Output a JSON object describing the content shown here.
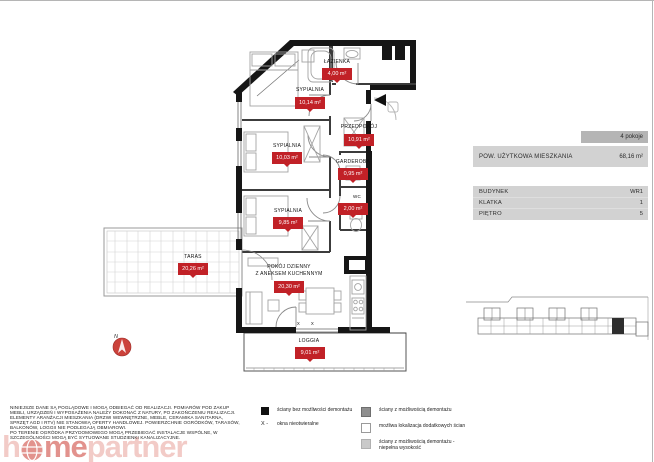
{
  "colors": {
    "badge_red": "#c12127",
    "wall_black": "#161616",
    "panel_gray": "#d2d2d2",
    "panel_band_gray": "#b5b5b5",
    "logo_salmon": "#eba9a3",
    "logo_red": "#cf4a42"
  },
  "floorplan": {
    "north_label": "N",
    "window_marker": "x",
    "rooms": [
      {
        "name": "ŁAZIENKA",
        "area": "4,00 m²"
      },
      {
        "name": "SYPIALNIA",
        "area": "10,14 m²"
      },
      {
        "name": "PRZEDPOKÓJ",
        "area": "10,91 m²"
      },
      {
        "name": "SYPIALNIA",
        "area": "10,03 m²"
      },
      {
        "name": "GARDEROBA",
        "area": "0,95 m²"
      },
      {
        "name": "WC",
        "area": "2,00 m²"
      },
      {
        "name": "SYPIALNIA",
        "area": "9,85 m²"
      },
      {
        "name": "TARAS",
        "area": "20,26 m²"
      },
      {
        "name": "POKÓJ DZIENNY",
        "name_line2": "Z ANEKSEM KUCHENNYM",
        "area": "20,30 m²"
      },
      {
        "name": "LOGGIA",
        "area": "9,01 m²"
      }
    ]
  },
  "info_panel": {
    "rooms_count": "4 pokoje",
    "area_label": "POW. UŻYTKOWA MIESZKANIA",
    "area_value": "68,16 m²",
    "rows": [
      {
        "label": "BUDYNEK",
        "value": "WR1"
      },
      {
        "label": "KLATKA",
        "value": "1"
      },
      {
        "label": "PIĘTRO",
        "value": "5"
      }
    ]
  },
  "legend": {
    "col1": [
      {
        "swatch": "black",
        "label": "ściany bez możliwości demontażu"
      },
      {
        "swatch": "x-symbol",
        "symbol": "X -",
        "label": "okna nieotwieralne"
      }
    ],
    "col2": [
      {
        "swatch": "dark-gray",
        "label": "ściany z możliwością demontażu"
      },
      {
        "swatch": "white",
        "label": "możliwa lokalizacja dodatkowych ścian"
      },
      {
        "swatch": "light-gray",
        "label": "ściany z możliwością demontażu - niepełna wysokość"
      }
    ]
  },
  "disclaimer": {
    "lines": [
      "NINIEJSZE DANE SĄ POGLĄDOWE I MOGĄ ODBIEGAĆ OD REALIZACJI. POMIARÓW POD ZAKUP",
      "MEBLI, URZĄDZEŃ I WYPOSAŻENIA NALEŻY DOKONAĆ Z NATURY, PO ZAKOŃCZENIU REALIZACJI.",
      "ELEMENTY ARANŻACJI MIESZKANIA (DRZWI WEWNĘTRZNE, MEBLE, CERAMIKA SANITARNA,",
      "SPRZĘT AGD I RTV) NIE STANOWIĄ OFERTY HANDLOWEJ. POWIERZCHNIE OGRÓDKÓW, TARASÓW,",
      "BALKONÓW, LOGGII NIE PODLEGAJĄ OBMIAROWI.",
      "PO TERENIE OGRÓDKA PRZYDOMOWEGO MOGĄ PRZEBIEGAĆ INSTALACJE WSPÓLNE, W",
      "SZCZEGÓLNOŚCI MOGĄ BYĆ SYTUOWANE STUDZIENKI KANALIZACYJNE."
    ]
  },
  "logo": {
    "prefix": "h",
    "mid": "me",
    "suffix": "partner"
  }
}
